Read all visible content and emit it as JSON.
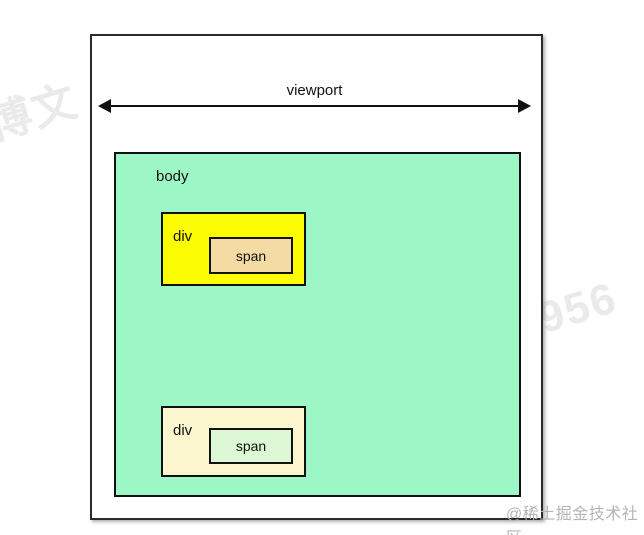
{
  "page": {
    "background": "#ffffff"
  },
  "watermarks": {
    "diagonal_text": "李博文 1956",
    "community_credit": "@稀土掘金技术社区"
  },
  "diagram": {
    "viewport": {
      "label": "viewport",
      "fill": "#ffffff",
      "border": "#2b2b2b"
    },
    "body": {
      "label": "body",
      "fill": "#9cf6c6",
      "border": "#111111"
    },
    "divs": [
      {
        "label": "div",
        "fill": "#fcfc03",
        "border": "#111111",
        "span": {
          "label": "span",
          "fill": "#f4dba4",
          "border": "#111111"
        }
      },
      {
        "label": "div",
        "fill": "#fbf6ce",
        "border": "#111111",
        "span": {
          "label": "span",
          "fill": "#ddf8d4",
          "border": "#111111"
        }
      }
    ]
  }
}
